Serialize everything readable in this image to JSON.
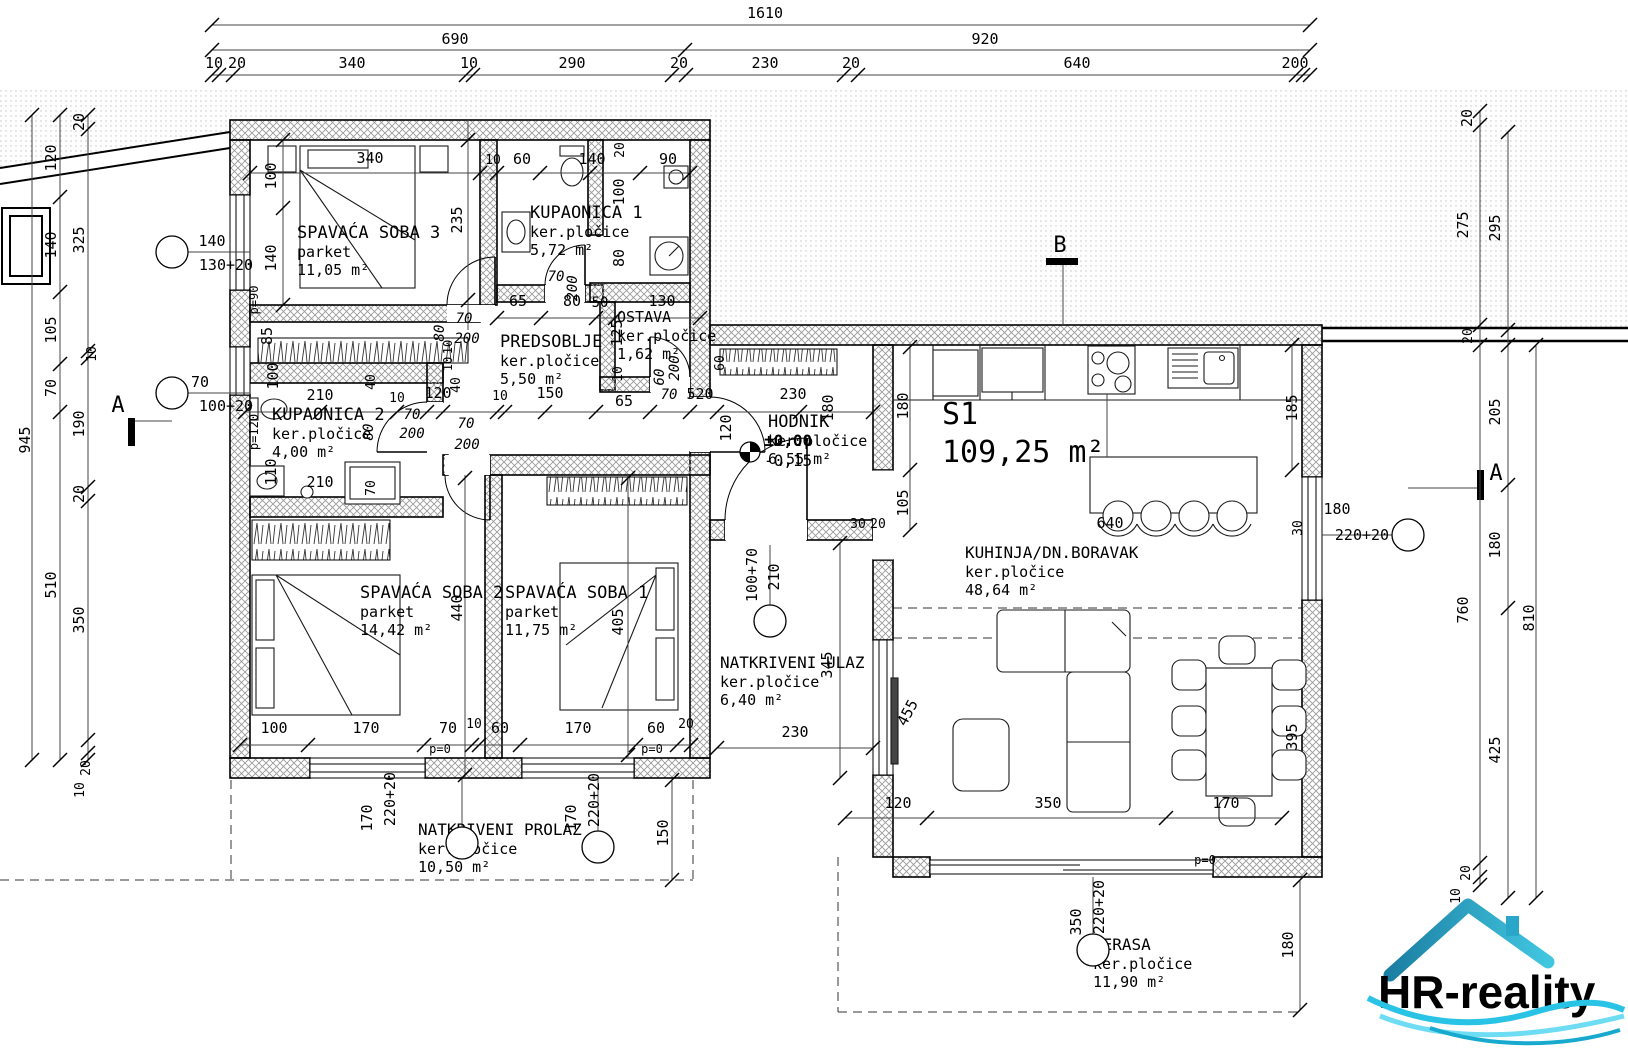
{
  "logo": {
    "text": "HR-reality"
  },
  "unit": {
    "name": "S1",
    "area": "109,25 m²",
    "x": 942,
    "y": 424
  },
  "level_marker": {
    "x": 750,
    "y": 452,
    "upper": "±0,00",
    "lower": "-0,15"
  },
  "rooms": [
    {
      "name": "SPAVAĆA SOBA 3",
      "material": "parket",
      "area": "11,05 m²",
      "x": 297,
      "y": 238
    },
    {
      "name": "KUPAONICA 1",
      "material": "ker.pločice",
      "area": "5,72 m²",
      "x": 530,
      "y": 218
    },
    {
      "name": "OSTAVA",
      "material": "ker.pločice",
      "area": "1,62 m²",
      "x": 617,
      "y": 322,
      "s": 15
    },
    {
      "name": "PREDSOBLJE",
      "material": "ker.pločice",
      "area": "5,50 m²",
      "x": 500,
      "y": 347
    },
    {
      "name": "KUPAONICA 2",
      "material": "ker.pločice",
      "area": "4,00 m²",
      "x": 272,
      "y": 420
    },
    {
      "name": "HODNIK",
      "material": "ker.pločice",
      "area": "6,55 m²",
      "x": 768,
      "y": 427
    },
    {
      "name": "SPAVAĆA SOBA 2",
      "material": "parket",
      "area": "14,42 m²",
      "x": 360,
      "y": 598
    },
    {
      "name": "SPAVAĆA SOBA 1",
      "material": "parket",
      "area": "11,75 m²",
      "x": 505,
      "y": 598
    },
    {
      "name": "KUHINJA/DN.BORAVAK",
      "material": "ker.pločice",
      "area": "48,64 m²",
      "x": 965,
      "y": 558,
      "s": 16
    },
    {
      "name": "NATKRIVENI ULAZ",
      "material": "ker.pločice",
      "area": "6,40 m²",
      "x": 720,
      "y": 668,
      "s": 16
    },
    {
      "name": "NATKRIVENI PROLAZ",
      "material": "ker.pločice",
      "area": "10,50 m²",
      "x": 418,
      "y": 835,
      "s": 16
    },
    {
      "name": "TERASA",
      "material": "ker.pločice",
      "area": "11,90 m²",
      "x": 1093,
      "y": 950,
      "s": 16
    }
  ],
  "position_markers": [
    {
      "x": 172,
      "y": 252,
      "labels": [
        {
          "t": "140",
          "x": 212,
          "y": 246
        },
        {
          "t": "130+20",
          "x": 226,
          "y": 270
        }
      ]
    },
    {
      "x": 172,
      "y": 393,
      "labels": [
        {
          "t": "70",
          "x": 200,
          "y": 387
        },
        {
          "t": "100+20",
          "x": 226,
          "y": 411
        }
      ]
    },
    {
      "x": 770,
      "y": 621,
      "labels": [
        {
          "t": "100+70",
          "x": 757,
          "y": 575,
          "r": 1
        },
        {
          "t": "210",
          "x": 779,
          "y": 577,
          "r": 1
        }
      ]
    },
    {
      "x": 462,
      "y": 843,
      "labels": [
        {
          "t": "170",
          "x": 372,
          "y": 818,
          "r": 1
        },
        {
          "t": "220+20",
          "x": 395,
          "y": 799,
          "r": 1
        }
      ]
    },
    {
      "x": 598,
      "y": 847,
      "labels": [
        {
          "t": "170",
          "x": 576,
          "y": 818,
          "r": 1
        },
        {
          "t": "220+20",
          "x": 599,
          "y": 800,
          "r": 1
        }
      ]
    },
    {
      "x": 1408,
      "y": 535,
      "labels": [
        {
          "t": "180",
          "x": 1337,
          "y": 514
        },
        {
          "t": "220+20",
          "x": 1362,
          "y": 540
        }
      ]
    },
    {
      "x": 1093,
      "y": 950,
      "labels": [
        {
          "t": "350",
          "x": 1081,
          "y": 922,
          "r": 1
        },
        {
          "t": "220+20",
          "x": 1104,
          "y": 907,
          "r": 1
        }
      ]
    }
  ],
  "annotations": [
    {
      "t": "1610",
      "x": 765,
      "y": 18
    },
    {
      "t": "690",
      "x": 455,
      "y": 44
    },
    {
      "t": "920",
      "x": 985,
      "y": 44
    },
    {
      "t": "10",
      "x": 214,
      "y": 68
    },
    {
      "t": "20",
      "x": 237,
      "y": 68
    },
    {
      "t": "340",
      "x": 352,
      "y": 68
    },
    {
      "t": "10",
      "x": 469,
      "y": 68
    },
    {
      "t": "290",
      "x": 572,
      "y": 68
    },
    {
      "t": "20",
      "x": 679,
      "y": 68
    },
    {
      "t": "230",
      "x": 765,
      "y": 68
    },
    {
      "t": "20",
      "x": 851,
      "y": 68
    },
    {
      "t": "640",
      "x": 1077,
      "y": 68
    },
    {
      "t": "200",
      "x": 1295,
      "y": 68
    },
    {
      "t": "945",
      "x": 30,
      "y": 440,
      "r": 1
    },
    {
      "t": "120",
      "x": 56,
      "y": 158,
      "r": 1
    },
    {
      "t": "140",
      "x": 56,
      "y": 245,
      "r": 1
    },
    {
      "t": "105",
      "x": 56,
      "y": 330,
      "r": 1
    },
    {
      "t": "70",
      "x": 56,
      "y": 388,
      "r": 1
    },
    {
      "t": "510",
      "x": 56,
      "y": 585,
      "r": 1
    },
    {
      "t": "20",
      "x": 84,
      "y": 122,
      "r": 1
    },
    {
      "t": "325",
      "x": 84,
      "y": 240,
      "r": 1
    },
    {
      "t": "10",
      "x": 96,
      "y": 354,
      "r": 1,
      "s": 13
    },
    {
      "t": "190",
      "x": 84,
      "y": 424,
      "r": 1
    },
    {
      "t": "20",
      "x": 84,
      "y": 494,
      "r": 1
    },
    {
      "t": "350",
      "x": 84,
      "y": 620,
      "r": 1
    },
    {
      "t": "20",
      "x": 90,
      "y": 768,
      "r": 1,
      "s": 13
    },
    {
      "t": "10",
      "x": 84,
      "y": 790,
      "r": 1,
      "s": 13
    },
    {
      "t": "20",
      "x": 1472,
      "y": 118,
      "r": 1
    },
    {
      "t": "275",
      "x": 1468,
      "y": 225,
      "r": 1
    },
    {
      "t": "295",
      "x": 1500,
      "y": 228,
      "r": 1
    },
    {
      "t": "20",
      "x": 1472,
      "y": 336,
      "r": 1,
      "s": 13
    },
    {
      "t": "205",
      "x": 1500,
      "y": 412,
      "r": 1
    },
    {
      "t": "180",
      "x": 1500,
      "y": 545,
      "r": 1
    },
    {
      "t": "760",
      "x": 1468,
      "y": 610,
      "r": 1
    },
    {
      "t": "810",
      "x": 1534,
      "y": 618,
      "r": 1
    },
    {
      "t": "425",
      "x": 1500,
      "y": 750,
      "r": 1
    },
    {
      "t": "20",
      "x": 1470,
      "y": 873,
      "r": 1,
      "s": 13
    },
    {
      "t": "10",
      "x": 1460,
      "y": 896,
      "r": 1,
      "s": 13
    },
    {
      "t": "180",
      "x": 1293,
      "y": 945,
      "r": 1
    },
    {
      "t": "120",
      "x": 898,
      "y": 808
    },
    {
      "t": "350",
      "x": 1048,
      "y": 808
    },
    {
      "t": "170",
      "x": 1226,
      "y": 808
    },
    {
      "t": "100",
      "x": 274,
      "y": 733
    },
    {
      "t": "170",
      "x": 366,
      "y": 733
    },
    {
      "t": "70",
      "x": 448,
      "y": 733
    },
    {
      "t": "10",
      "x": 474,
      "y": 728,
      "s": 13
    },
    {
      "t": "60",
      "x": 500,
      "y": 733
    },
    {
      "t": "170",
      "x": 578,
      "y": 733
    },
    {
      "t": "60",
      "x": 656,
      "y": 733
    },
    {
      "t": "20",
      "x": 686,
      "y": 728,
      "s": 13
    },
    {
      "t": "p=90",
      "x": 258,
      "y": 300,
      "r": 1,
      "s": 12,
      "n": "parapet-label"
    },
    {
      "t": "p=120",
      "x": 258,
      "y": 432,
      "r": 1,
      "s": 12,
      "n": "parapet-label"
    },
    {
      "t": "p=0",
      "x": 440,
      "y": 753,
      "s": 12,
      "n": "parapet-label"
    },
    {
      "t": "p=0",
      "x": 652,
      "y": 753,
      "s": 12,
      "n": "parapet-label"
    },
    {
      "t": "p=0",
      "x": 1205,
      "y": 864,
      "s": 12,
      "n": "parapet-label"
    },
    {
      "t": "340",
      "x": 370,
      "y": 163
    },
    {
      "t": "100",
      "x": 276,
      "y": 176,
      "r": 1
    },
    {
      "t": "140",
      "x": 276,
      "y": 258,
      "r": 1
    },
    {
      "t": "235",
      "x": 462,
      "y": 220,
      "r": 1
    },
    {
      "t": "10",
      "x": 493,
      "y": 164,
      "s": 13
    },
    {
      "t": "60",
      "x": 522,
      "y": 164
    },
    {
      "t": "140",
      "x": 592,
      "y": 164
    },
    {
      "t": "90",
      "x": 668,
      "y": 164
    },
    {
      "t": "20",
      "x": 624,
      "y": 150,
      "r": 1,
      "s": 13
    },
    {
      "t": "100",
      "x": 624,
      "y": 192,
      "r": 1
    },
    {
      "t": "80",
      "x": 624,
      "y": 258,
      "r": 1
    },
    {
      "t": "70",
      "x": 556,
      "y": 281,
      "i": 1,
      "s": 14
    },
    {
      "t": "200",
      "x": 577,
      "y": 288,
      "r": 1,
      "i": 1,
      "s": 14
    },
    {
      "t": "65",
      "x": 518,
      "y": 306
    },
    {
      "t": "80",
      "x": 572,
      "y": 306
    },
    {
      "t": "50",
      "x": 600,
      "y": 307,
      "s": 14
    },
    {
      "t": "130",
      "x": 662,
      "y": 306
    },
    {
      "t": "125",
      "x": 622,
      "y": 333,
      "r": 1
    },
    {
      "t": "10",
      "x": 622,
      "y": 374,
      "r": 1,
      "s": 13
    },
    {
      "t": "60",
      "x": 664,
      "y": 377,
      "r": 1,
      "i": 1,
      "s": 14
    },
    {
      "t": "200",
      "x": 679,
      "y": 368,
      "r": 1,
      "i": 1,
      "s": 14
    },
    {
      "t": "70",
      "x": 669,
      "y": 399,
      "i": 1,
      "s": 14
    },
    {
      "t": "70",
      "x": 464,
      "y": 323,
      "i": 1,
      "s": 14
    },
    {
      "t": "200",
      "x": 467,
      "y": 343,
      "i": 1,
      "s": 14
    },
    {
      "t": "80",
      "x": 444,
      "y": 333,
      "r": 1,
      "i": 1,
      "s": 14
    },
    {
      "t": "120",
      "x": 438,
      "y": 398
    },
    {
      "t": "10",
      "x": 500,
      "y": 400,
      "s": 13
    },
    {
      "t": "150",
      "x": 550,
      "y": 398
    },
    {
      "t": "65",
      "x": 624,
      "y": 406
    },
    {
      "t": "520",
      "x": 700,
      "y": 399
    },
    {
      "t": "230",
      "x": 793,
      "y": 399
    },
    {
      "t": "180",
      "x": 833,
      "y": 408,
      "r": 1
    },
    {
      "t": "120",
      "x": 731,
      "y": 428,
      "r": 1
    },
    {
      "t": "210",
      "x": 320,
      "y": 400
    },
    {
      "t": "210",
      "x": 320,
      "y": 487
    },
    {
      "t": "40",
      "x": 375,
      "y": 382,
      "r": 1,
      "s": 13
    },
    {
      "t": "100",
      "x": 278,
      "y": 376,
      "r": 1
    },
    {
      "t": "85",
      "x": 272,
      "y": 336,
      "r": 1
    },
    {
      "t": "110",
      "x": 276,
      "y": 472,
      "r": 1
    },
    {
      "t": "70",
      "x": 412,
      "y": 419,
      "i": 1,
      "s": 14
    },
    {
      "t": "200",
      "x": 412,
      "y": 438,
      "i": 1,
      "s": 14
    },
    {
      "t": "80",
      "x": 373,
      "y": 432,
      "r": 1,
      "i": 1,
      "s": 14
    },
    {
      "t": "70",
      "x": 375,
      "y": 488,
      "r": 1,
      "s": 13
    },
    {
      "t": "40",
      "x": 460,
      "y": 385,
      "r": 1,
      "s": 13
    },
    {
      "t": "10",
      "x": 452,
      "y": 364,
      "r": 1,
      "s": 12
    },
    {
      "t": "10",
      "x": 452,
      "y": 347,
      "r": 1,
      "s": 12
    },
    {
      "t": "10",
      "x": 397,
      "y": 402,
      "s": 13
    },
    {
      "t": "70",
      "x": 466,
      "y": 428,
      "i": 1,
      "s": 14
    },
    {
      "t": "200",
      "x": 467,
      "y": 449,
      "i": 1,
      "s": 14
    },
    {
      "t": "60",
      "x": 724,
      "y": 363,
      "r": 1,
      "s": 13
    },
    {
      "t": "180",
      "x": 908,
      "y": 406,
      "r": 1
    },
    {
      "t": "105",
      "x": 908,
      "y": 503,
      "r": 1
    },
    {
      "t": "185",
      "x": 1297,
      "y": 408,
      "r": 1
    },
    {
      "t": "30",
      "x": 1302,
      "y": 528,
      "r": 1,
      "s": 13
    },
    {
      "t": "30",
      "x": 858,
      "y": 528,
      "s": 13
    },
    {
      "t": "20",
      "x": 878,
      "y": 528,
      "s": 13
    },
    {
      "t": "640",
      "x": 1110,
      "y": 528
    },
    {
      "t": "455",
      "x": 912,
      "y": 715,
      "rr": -62
    },
    {
      "t": "440",
      "x": 462,
      "y": 608,
      "r": 1
    },
    {
      "t": "405",
      "x": 623,
      "y": 622,
      "r": 1
    },
    {
      "t": "345",
      "x": 832,
      "y": 665,
      "r": 1
    },
    {
      "t": "230",
      "x": 795,
      "y": 737
    },
    {
      "t": "150",
      "x": 668,
      "y": 833,
      "r": 1
    },
    {
      "t": "395",
      "x": 1297,
      "y": 737,
      "r": 1
    },
    {
      "t": "A",
      "x": 118,
      "y": 412,
      "s": 22,
      "n": "section-label"
    },
    {
      "t": "A",
      "x": 1496,
      "y": 480,
      "s": 22,
      "n": "section-label"
    },
    {
      "t": "B",
      "x": 1060,
      "y": 252,
      "s": 22,
      "n": "section-label"
    }
  ]
}
